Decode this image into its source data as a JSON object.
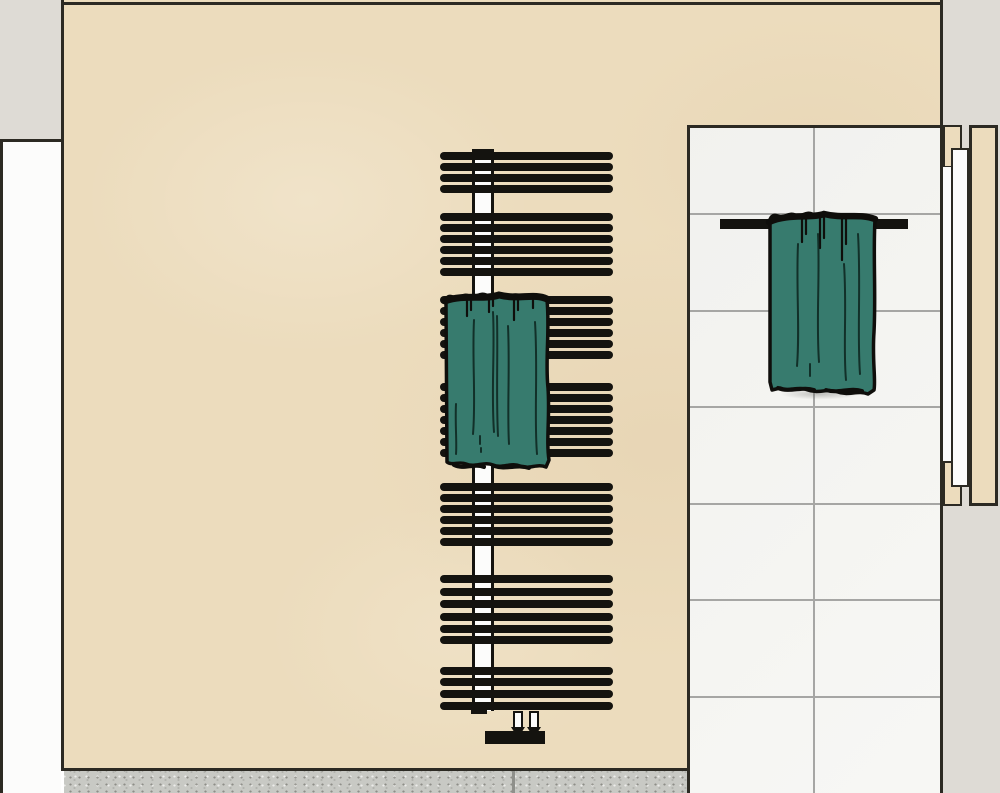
{
  "scene": {
    "title": "Bathroom wall illustration with towel radiator and towel bar",
    "colors": {
      "beige": "#ecdcbd",
      "panel_gray": "#dedbd5",
      "door_white": "#fcfcfb",
      "tile": "#f7f7f4",
      "grout": "#a6a6a4",
      "line_dark": "#2c2a23",
      "ink": "#14130f",
      "teal": "#377b6e",
      "teal_fold": "#0f2822",
      "floor": "#c8c9c4",
      "floor_joint": "#8f908b"
    },
    "objects": {
      "main_wall": "beige plaster wall",
      "left_return": "left wall return and white door edge",
      "tiled_wall": "white tiled wall",
      "right_door": "right door frame with white door leaf",
      "radiator": "black towel radiator with white riser column",
      "radiator_towel": "teal towel draped over radiator",
      "towel_bar": "black wall towel bar",
      "wall_towel": "teal towel on towel bar",
      "floor": "speckled floor strip"
    }
  },
  "radiator": {
    "rung_x": 440,
    "rung_width": 173,
    "rung_height": 8,
    "rung_groups": [
      [
        152,
        163,
        174,
        185
      ],
      [
        213,
        224,
        235,
        246,
        257,
        268
      ],
      [
        296,
        307,
        318,
        329,
        340,
        351
      ],
      [
        383,
        394,
        405,
        416,
        427,
        438,
        449
      ],
      [
        483,
        494,
        505,
        516,
        527,
        538
      ],
      [
        575,
        588,
        600,
        613,
        625,
        636
      ],
      [
        667,
        678,
        690,
        702
      ]
    ],
    "column": {
      "x": 472,
      "top": 149,
      "width": 22,
      "bottom": 711
    }
  },
  "tiles": {
    "left": 687,
    "top": 125,
    "right": 940,
    "bottom": 793,
    "vertical_joints_local": [
      126
    ],
    "horizontal_joints_local": [
      88,
      185,
      281,
      378,
      474,
      571
    ]
  },
  "towel_bar": {
    "x": 720,
    "y": 219,
    "width": 188,
    "height": 10
  },
  "floor": {
    "top": 771,
    "left": 64,
    "right": 687,
    "joint_x": 512
  }
}
